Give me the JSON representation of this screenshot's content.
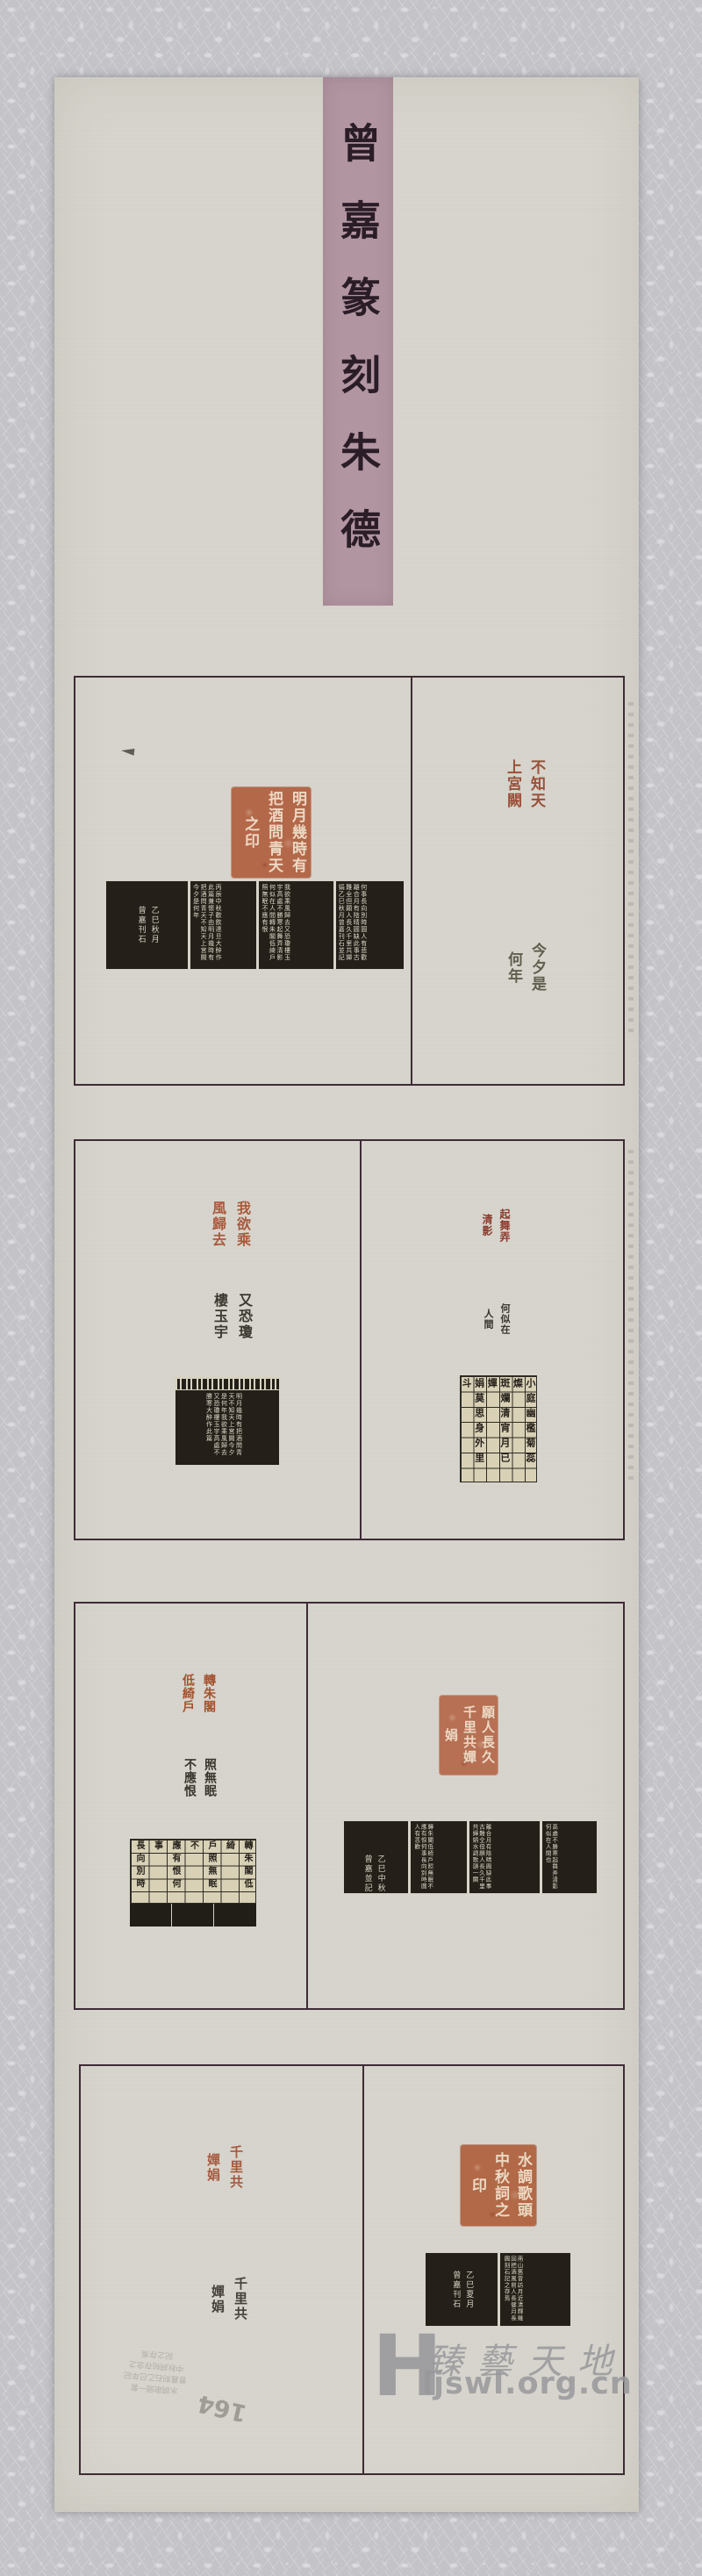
{
  "title_strip": {
    "text": "曾嘉篆刻朱德"
  },
  "panels": {
    "p1": {
      "left_seal": "明月幾時有把酒問青天之印",
      "rub_sig": "乙巳秋月\n曾嘉刊石",
      "rub_s2": "丙辰中秋歡飲達旦大醉作此篇兼懷子由明月幾時有把酒問青天不知天上宮闕今夕是何年",
      "rub_s3": "我欲乘風歸去又恐瓊樓玉宇高處不勝寒起舞弄清影何似在人間轉朱閣低綺戶照無眠不應有恨",
      "rub_s4": "何事長向別時圓人有悲歡離合月有陰晴圓缺此事古難全但願人長久千里共嬋娟乙巳秋月曾嘉刊石並記",
      "right_seal_top": "不知天上宮闕",
      "right_seal_bottom": "今夕是何年"
    },
    "p2": {
      "left_seal_red": "我欲乘風歸去",
      "left_seal_black": "又恐瓊樓玉宇",
      "rub_sig": "曾嘉\n刊石",
      "rub_text": "明月幾時有把酒問青天不知天上宮闕今夕是何年我欲乘風歸去又恐瓊樓玉宇高處不勝寒大醉作此篇",
      "right_seal_red": "起舞弄清影",
      "right_seal_black": "何似在人間",
      "grid_text": "小庭幽檻菊蕊燦\n斑斕清宵月已嬋\n娟莫思身外里斗\n尊前臨花長好人\n長健月長圓乙巳\n秋曾嘉刊石并記"
    },
    "p3": {
      "left_seal_red": "轉朱閣低綺戶",
      "left_seal_black": "照無眠不應恨",
      "grid_text": "轉朱閣低綺\n戶照無眠不\n應有恨何事\n長向別時圓\n人有悲歡離\n合月有陰晴\n嬋娟曾嘉記",
      "right_seal": "願人長久千里共嬋娟",
      "rub_sig": "乙巳中秋\n曾嘉並記",
      "rub_s2": "轉朱閣低綺戶照無眠不應有恨何事長向別時圓人有悲歡",
      "rub_s3": "離合月有陰晴圓缺此事古難全但願人長久千里共嬋娟水調歌頭一闋",
      "rub_s4": "高處不勝寒起舞弄清影何似在人間也"
    },
    "p4": {
      "left_seal_red": "千里共嬋娟",
      "left_seal_gray": "千里共嬋娟",
      "right_seal": "水調歌頭中秋詞之印",
      "rub_sig": "乙巳夏月\n曾嘉刊石",
      "rub_text": "南山舊曾訪月近清輝幾回把酒風前人長健月長圓刻石記之存焉"
    }
  },
  "watermark": {
    "letter": "H",
    "brand": "臻藝天地",
    "url": "ljswl.org.cn"
  },
  "pencil": {
    "scribble": "水調歌頭一套\n曾嘉刻石乙巳年記\n中秋詞帖存念之\n記之存焉",
    "number": "164"
  }
}
